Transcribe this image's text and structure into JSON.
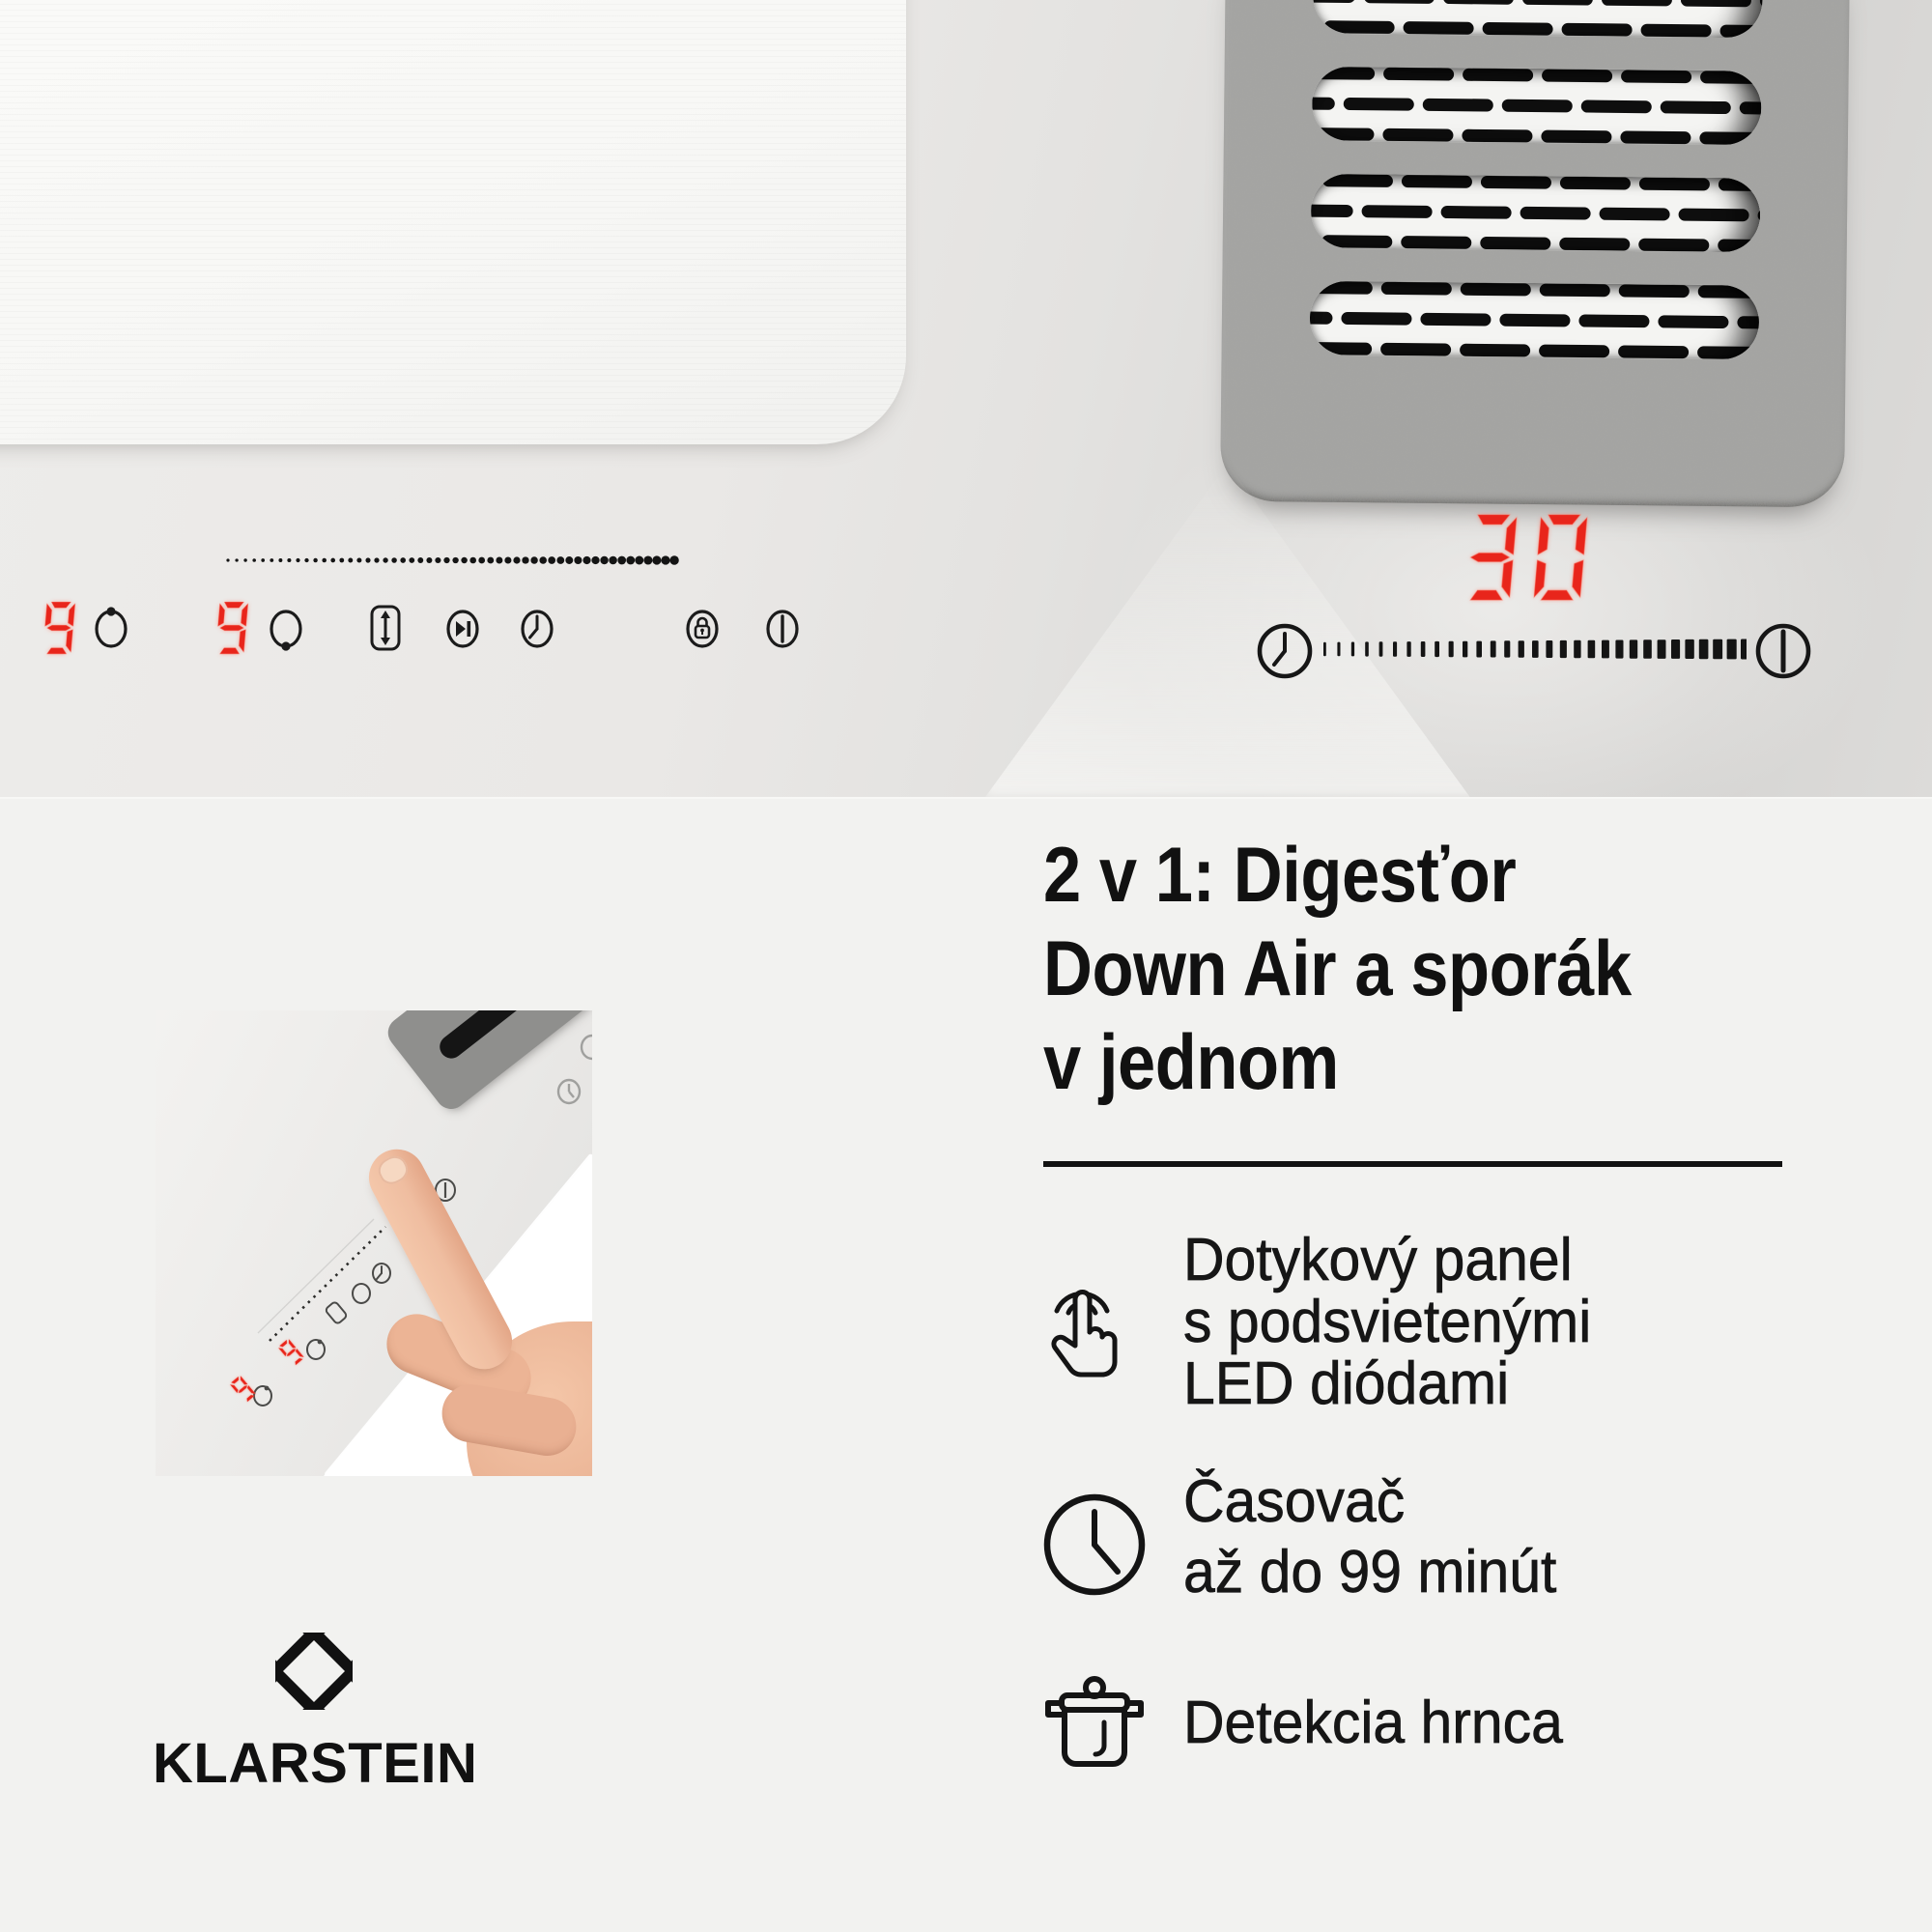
{
  "product_photo": {
    "left_display": {
      "zone1_level": "9",
      "zone2_level": "9"
    },
    "right_display": {
      "timer_value": "30"
    },
    "icons": {
      "zone_front": "cooking-zone-indicator-dot-top",
      "zone_back": "cooking-zone-indicator-dot-bottom",
      "bridge": "bridge-zone-icon",
      "boost": "boost-skip-icon",
      "timer_left": "timer-clock-icon",
      "lock": "child-lock-icon",
      "power_left": "power-icon",
      "timer_right": "timer-clock-icon",
      "power_right": "power-icon"
    }
  },
  "info": {
    "heading": {
      "line1": "2 v 1: Digesťor",
      "line2": "Down Air a sporák",
      "line3": "v jednom"
    },
    "features": [
      {
        "icon": "touch-icon",
        "lines": [
          "Dotykový panel",
          "s podsvietenými",
          "LED diódami"
        ]
      },
      {
        "icon": "clock-icon",
        "lines": [
          "Časovač",
          "až do 99 minút"
        ]
      },
      {
        "icon": "pot-icon",
        "lines": [
          "Detekcia hrnca"
        ]
      }
    ],
    "brand": {
      "wordmark": "KLARSTEIN"
    },
    "inset": {
      "zone1_level": "9",
      "zone2_level": "9"
    }
  },
  "colors": {
    "led_red": "#e8251b",
    "ink": "#141414",
    "info_bg": "#f2f2f0",
    "grille_gray": "#a3a3a1",
    "skin": "#efbda0"
  }
}
